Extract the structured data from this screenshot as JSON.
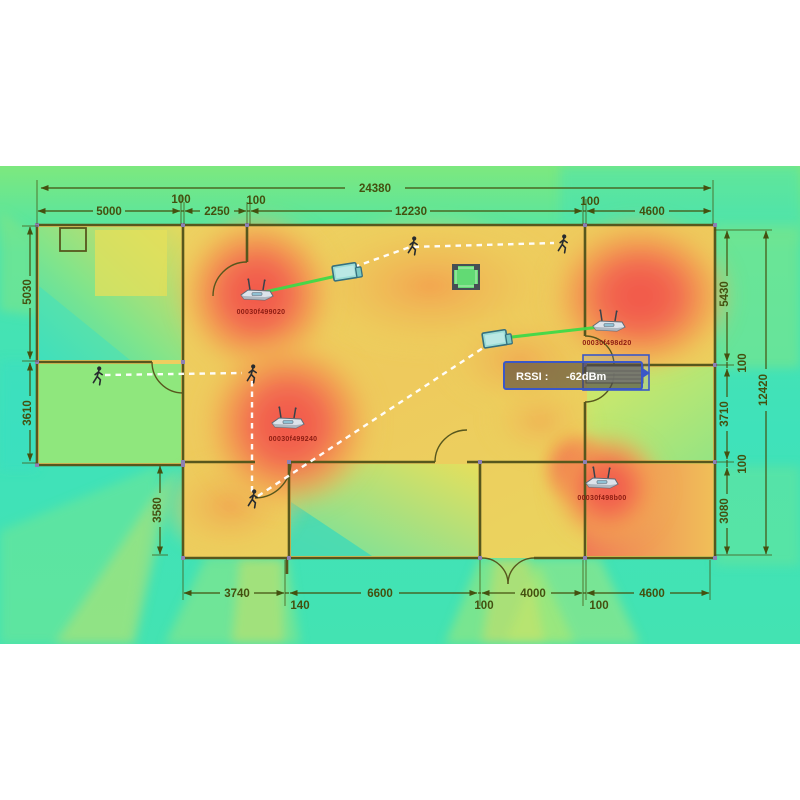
{
  "scene": {
    "description": "WiFi RSSI coverage heatmap over a building floor plan with access points, clients and walk paths"
  },
  "dimensions": {
    "top_total": "24380",
    "top_segments": [
      "5000",
      "100",
      "2250",
      "100",
      "12230",
      "100",
      "4600"
    ],
    "left_segments": [
      "5030",
      "3610"
    ],
    "left_inner": "3580",
    "right_segments": [
      "5430",
      "100",
      "3710",
      "100",
      "3080"
    ],
    "right_total": "12420",
    "bottom_segments": [
      "3740",
      "140",
      "6600",
      "100",
      "4000",
      "100",
      "4600"
    ]
  },
  "access_points": [
    {
      "id": "00030f499020"
    },
    {
      "id": "00030f498d20"
    },
    {
      "id": "00030f499240"
    },
    {
      "id": "00030f498b00"
    }
  ],
  "tooltip": {
    "label": "RSSI :",
    "value": "-62dBm"
  },
  "icons": {
    "access_point": "wireless-router",
    "client": "laptop",
    "person": "walking-person",
    "furniture": "table"
  },
  "colors": {
    "signal_strong": "#f2564a",
    "signal_medium": "#f2a04e",
    "signal_weak": "#e9d75f",
    "signal_low": "#8ce87a",
    "signal_none": "#3fe2ba",
    "link_active": "#3fd948",
    "walk_path": "#ffffff",
    "selection_border": "#3a57c8",
    "wall": "#57571d",
    "dimension_text": "#44500f",
    "ap_label_text": "#8c1c12"
  }
}
